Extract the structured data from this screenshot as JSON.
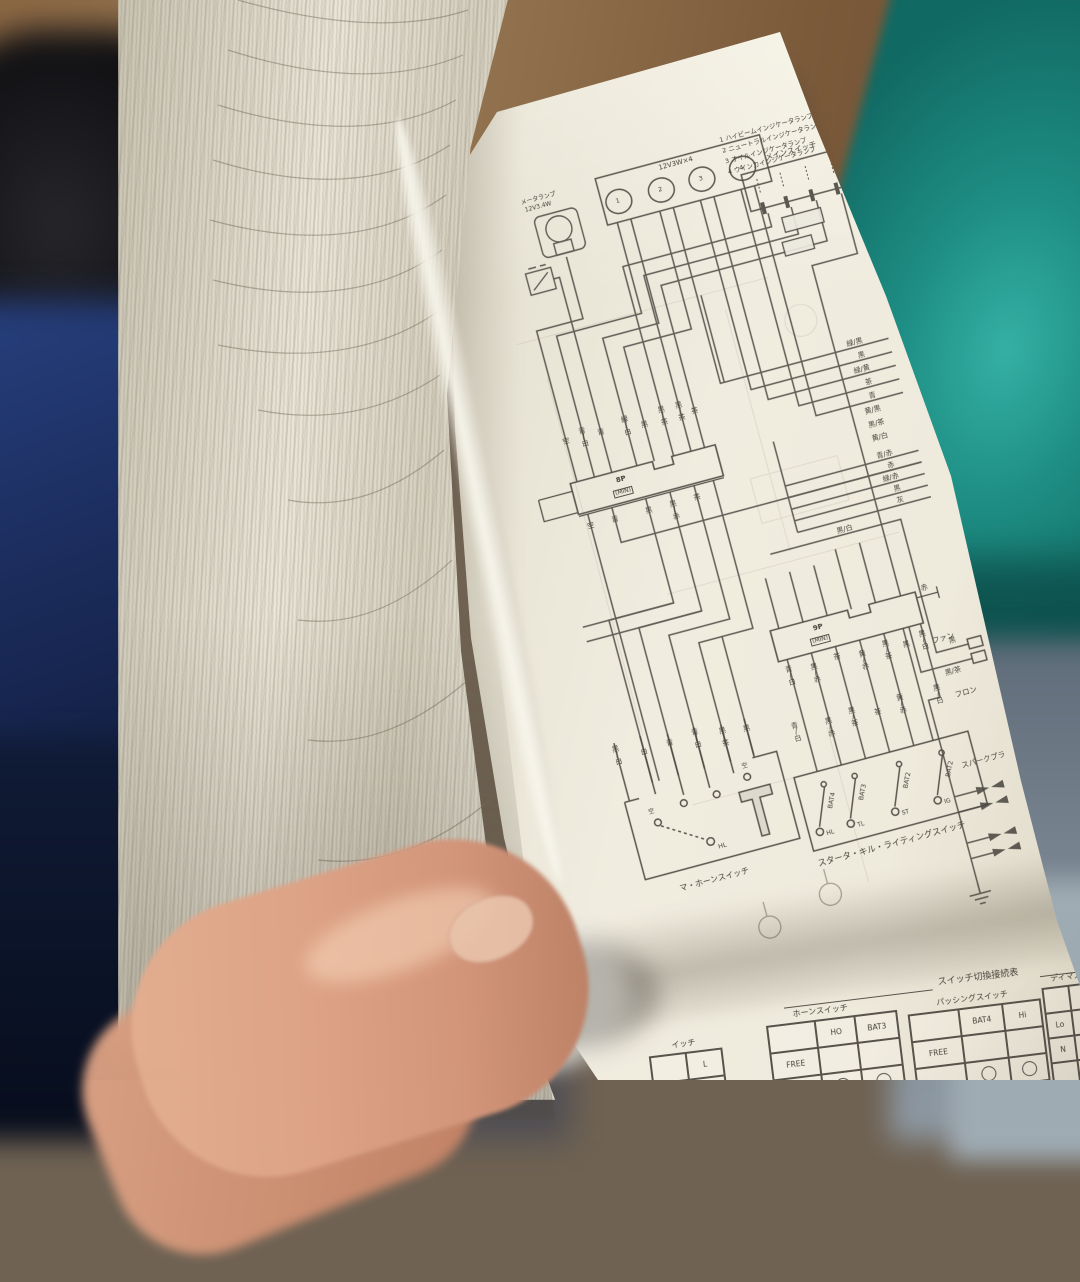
{
  "colors": {
    "paper": "#ece8db",
    "ink": "#45423a",
    "teal_book": "#1d8c82",
    "wood": "#8a6642",
    "navy": "#1b2c5c",
    "skin": "#dda387"
  },
  "legend": {
    "items": [
      "1 ハイビームインジケータランプ",
      "2 ニュートラルインジケータランプ",
      "3 オイルインジケータランプ",
      "4 ウインカインジケータランプ"
    ]
  },
  "components": {
    "meter_lamp": {
      "line1": "メータランプ",
      "line2": "12V3.4W"
    },
    "indicator_cluster": {
      "label": "12V3W×4",
      "bulbs": [
        "1",
        "2",
        "3",
        "4"
      ]
    },
    "main_switch": {
      "label": "メインスイッチ"
    },
    "fan": {
      "label": "ファン",
      "wires": [
        "黒",
        "黒/茶"
      ]
    },
    "front": {
      "label": "フロン"
    },
    "spark_plug": {
      "label": "スパークプラ"
    }
  },
  "connectors": {
    "c8p": {
      "pins": "8P",
      "type": "(MIN)",
      "above": [
        "空",
        "青/白",
        "青",
        "緑/白",
        "黒",
        "黒/茶",
        "黒/茶",
        "茶"
      ],
      "below": [
        "空",
        "青",
        "黒",
        "黒/赤",
        "茶"
      ]
    },
    "c9p": {
      "pins": "9P",
      "type": "(MIN)",
      "right": "赤",
      "below": [
        "青/白",
        "黒/赤",
        "茶",
        "黄/赤",
        "黒/茶",
        "黒",
        "黒/白"
      ]
    }
  },
  "wire_labels": {
    "right_a": [
      "緑/黒",
      "黒",
      "緑/黄",
      "茶",
      "青",
      "黄/黒",
      "黒/茶",
      "黄/白"
    ],
    "right_b": [
      "青/赤",
      "赤",
      "緑/赤",
      "黒",
      "灰"
    ],
    "right_c": "黒/白"
  },
  "switches": {
    "dimmer_horn": {
      "label": "マ・ホーンスイッチ",
      "above": [
        "黒/白",
        "白",
        "青",
        "青/白",
        "黒/茶",
        "黒"
      ],
      "contacts": [
        "空",
        "空",
        "HL"
      ]
    },
    "starter_kill": {
      "label": "スタータ・キル・ライティングスイッチ",
      "above": [
        "青/白",
        "黒/赤",
        "黒/茶",
        "茶",
        "黄/赤",
        "黒/白"
      ],
      "poles": [
        "BAT4",
        "BAT3",
        "BAT2",
        "BAT2"
      ],
      "throws": [
        "HL",
        "TL",
        "ST",
        "IG"
      ]
    }
  },
  "tables": {
    "title": "スイッチ切換接続表",
    "left_partial": {
      "header": "イッチ",
      "cell": "L"
    },
    "horn": {
      "name": "ホーンスイッチ",
      "col1": "HO",
      "col2": "BAT3",
      "row1": "FREE"
    },
    "passing": {
      "name": "パッシングスイッチ",
      "col1": "BAT4",
      "col2": "Hi",
      "row1": "FREE"
    },
    "dimmer": {
      "name": "ディマスイッチ",
      "col1": "HL",
      "col2": "Lo",
      "row1": "Lo",
      "row2": "N"
    }
  }
}
